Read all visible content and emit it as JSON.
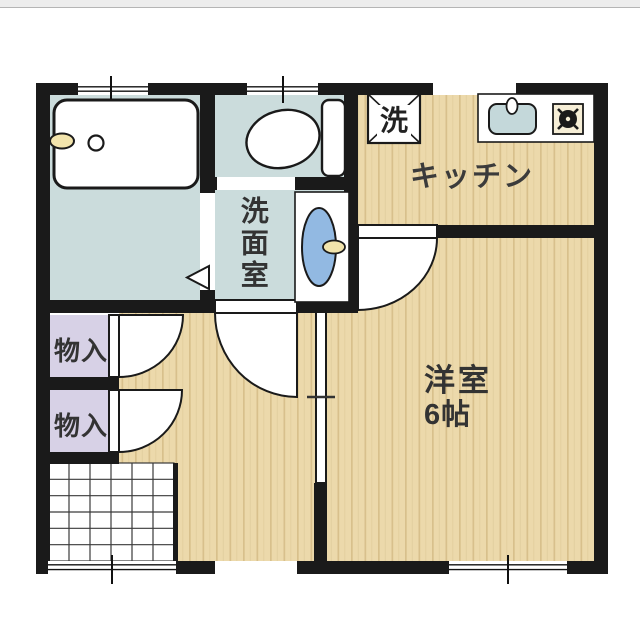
{
  "floorplan": {
    "type": "japanese-apartment-floor-plan",
    "rooms": {
      "kitchen": {
        "label": "キッチン"
      },
      "western_room": {
        "label": "洋室",
        "size": "6帖"
      },
      "washroom": {
        "label": "洗面室"
      },
      "storage_upper": {
        "label": "物入"
      },
      "storage_lower": {
        "label": "物入"
      },
      "washer": {
        "label": "洗"
      },
      "bathroom": {
        "label": ""
      },
      "toilet": {
        "label": ""
      }
    },
    "fixtures": [
      "bathtub",
      "bathtub-faucet",
      "bathtub-drain",
      "toilet",
      "washbasin",
      "washbasin-faucet",
      "washing-machine-box",
      "kitchen-counter",
      "kitchen-sink",
      "kitchen-faucet",
      "stove-burner",
      "entrance-grid",
      "door-swing-arc",
      "sliding-door-partition",
      "window-symbol",
      "bath-door-triangle"
    ],
    "colors": {
      "wall": "#1a1a1a",
      "wood_floor": "#ecd9ab",
      "wood_stripe": "#d8c08c",
      "wet_room_floor": "#cbdcdc",
      "storage_floor": "#d7d1e6",
      "basin_blue": "#92b9e2",
      "kitchen_sink_blue": "#c4d8da",
      "faucet_cream": "#f2e4ac",
      "stove_plate": "#f6eed6",
      "top_bar": "#ededed"
    }
  }
}
